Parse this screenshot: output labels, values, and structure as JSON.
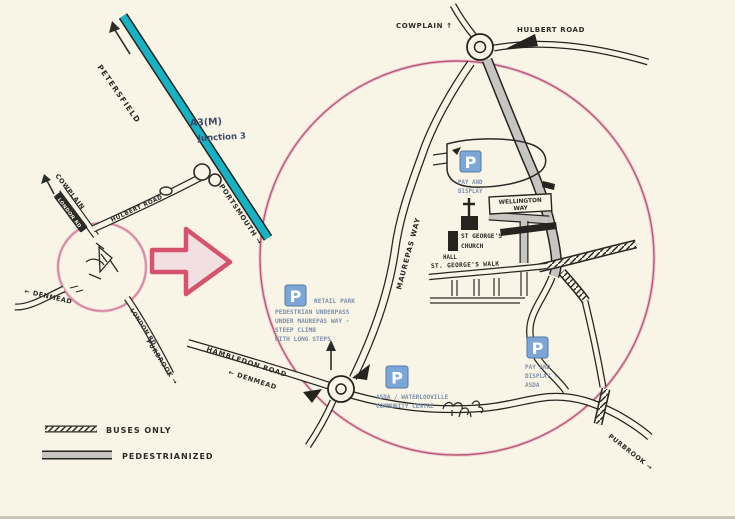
{
  "colors": {
    "background": "#f8f5e6",
    "ink": "#2b2b28",
    "a3_teal": "#17b2c3",
    "highlight_pink": "#d6536d",
    "circle_pink": "#c4607c",
    "parking_blue": "#7ca6d8",
    "caption_blue": "#7d8fa9",
    "pedestrian_gray": "#c6c5bf",
    "junction_navy": "#3c4a6b"
  },
  "icons": {
    "parking": "P",
    "north_arrow": "up-arrow",
    "direction_arrow": "arrow",
    "church": "cross"
  },
  "legend": {
    "buses_only": "BUSES ONLY",
    "pedestrianized": "PEDESTRIANIZED"
  },
  "overview": {
    "petersfield": "PETERSFIELD",
    "a3m": "A3(M)",
    "junction": "Junction 3",
    "cowplain": "COWPLAIN",
    "london_rd_north": "LONDON RD",
    "hulbert_road": "HULBERT ROAD",
    "portsmouth": "PORTSMOUTH →",
    "denmead": "← DENMEAD",
    "london_rd_south": "LONDON RD",
    "purbrook": "PURBROOK →"
  },
  "detail": {
    "cowplain": "COWPLAIN ↑",
    "hulbert_road": "HULBERT ROAD",
    "maurepas_way": "MAUREPAS WAY",
    "wellington_line1": "WELLINGTON",
    "wellington_line2": "WAY",
    "church_line1": "ST GEORGE'S",
    "church_line2": "CHURCH",
    "hall": "HALL",
    "st_georges_walk": "ST. GEORGE'S WALK",
    "hambledon_road": "HAMBLEDON ROAD",
    "denmead": "← DENMEAD",
    "purbrook": "PURBROOK →",
    "parking_symbol": "P",
    "car_parks": {
      "pay_display": {
        "line1": "PAY AND",
        "line2": "DISPLAY"
      },
      "retail": {
        "title": "RETAIL PARK",
        "note1": "PEDESTRIAN UNDERPASS",
        "note2": "UNDER MAUREPAS WAY -",
        "note3": "STEEP CLIMB",
        "note4": "WITH LONG STEPS"
      },
      "asda_cc": {
        "line1": "ASDA / WATERLOOVILLE",
        "line2": "COMMUNITY CENTRE"
      },
      "asda_pay": {
        "line1": "PAY AND",
        "line2": "DISPLAY -",
        "line3": "ASDA"
      }
    }
  }
}
